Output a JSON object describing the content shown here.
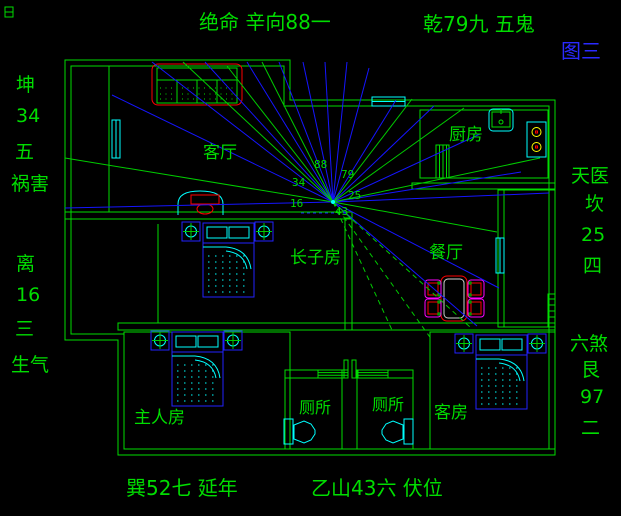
{
  "figure_label": "图三",
  "compass": {
    "top": "绝命 辛向88一",
    "top_right": "乾79九 五鬼",
    "left_upper": [
      "坤",
      "34",
      "五",
      "祸害"
    ],
    "left_lower": [
      "离",
      "16",
      "三",
      "生气"
    ],
    "right_upper": [
      "天医",
      "坎",
      "25",
      "四"
    ],
    "right_lower": [
      "六煞",
      "艮",
      "97",
      "二"
    ],
    "bottom_left": "巽52七 延年",
    "bottom_center": "乙山43六 伏位"
  },
  "rooms": [
    "客厅",
    "厨房",
    "长子房",
    "餐厅",
    "主人房",
    "厕所",
    "厕所",
    "客房"
  ],
  "center_numbers": [
    "88",
    "79",
    "34",
    "25",
    "16",
    "43"
  ],
  "colors": {
    "background": "#000000",
    "wall": "#00dd00",
    "text": "#00dd00",
    "sight_line_blue": "#1515ff",
    "sight_line_green": "#00cc00",
    "fixture_cyan": "#00ffff",
    "furniture_blue": "#2222ff",
    "highlight_red": "#ff0000",
    "chair_magenta": "#ff00ff",
    "burner_yellow": "#ffff00",
    "figure_label_blue": "#2a2aff"
  }
}
